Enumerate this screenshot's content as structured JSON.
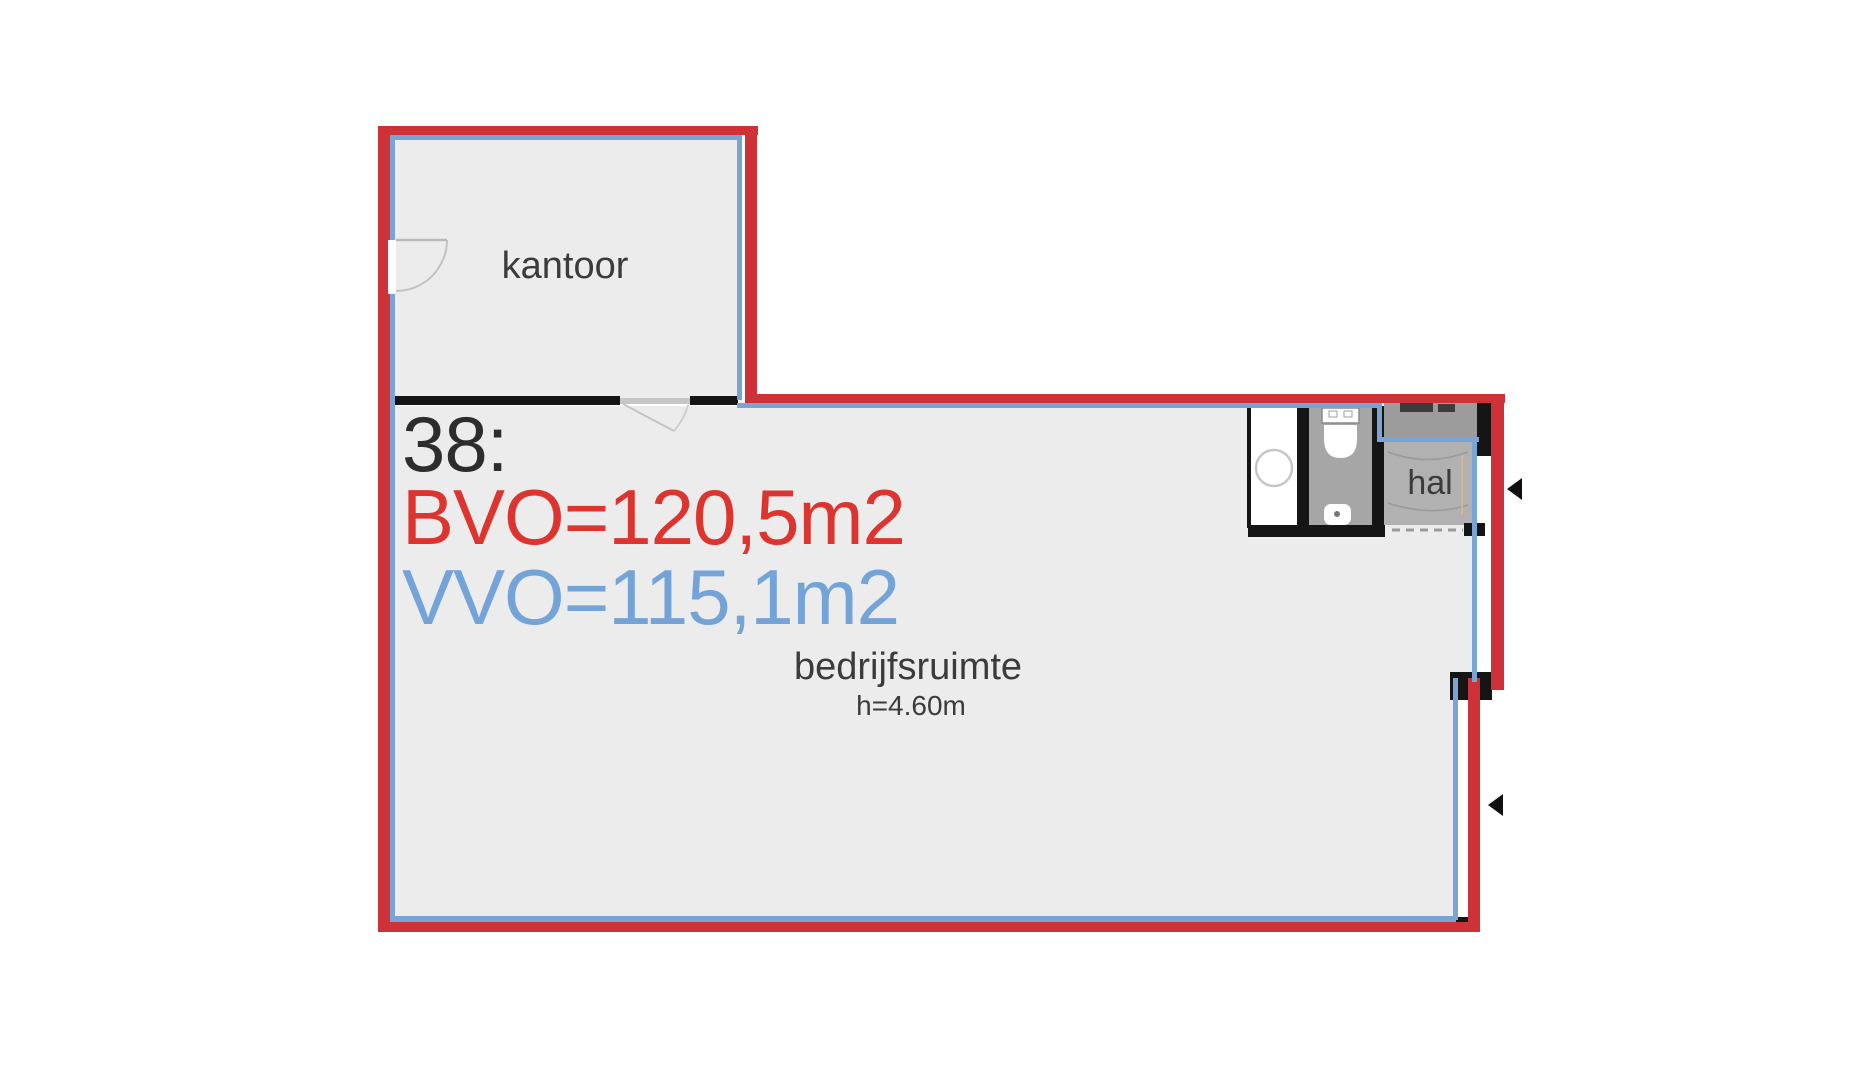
{
  "plan": {
    "labels": {
      "unit": "38:",
      "bvo": "BVO=120,5m2",
      "vvo": "VVO=115,1m2"
    },
    "rooms": {
      "kantoor": "kantoor",
      "bedrijfsruimte": "bedrijfsruimte",
      "bedrijfsruimte_height": "h=4.60m",
      "hal": "hal"
    },
    "colors": {
      "bvo_outline_red": "#ce3137",
      "vvo_outline_blue": "#7aa3d6",
      "bvo_text_red": "#dc3530",
      "vvo_text_blue": "#74a3d8",
      "wall_black": "#151515",
      "floor_fill": "#ececed",
      "toilet_gray": "#a6a6a6",
      "hal_gray": "#b1b1b1",
      "meter_cupboard_gray": "#9c9c9c",
      "text_dark": "#3b3b3b"
    }
  }
}
